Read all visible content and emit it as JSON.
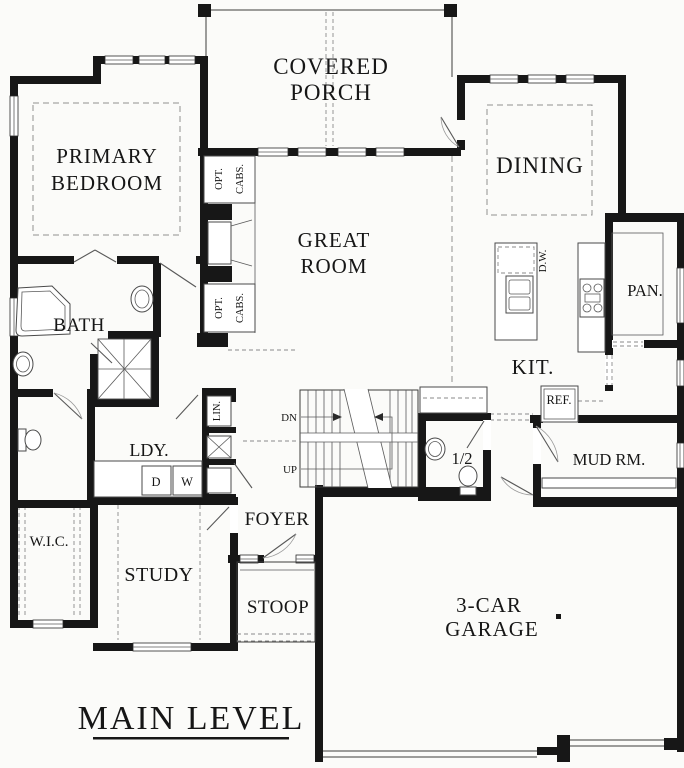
{
  "page": {
    "background": "#fbfbf9",
    "ink": "#171717"
  },
  "title": {
    "main_level": "MAIN LEVEL"
  },
  "labels": {
    "covered_porch": [
      "COVERED",
      "PORCH"
    ],
    "primary_bedroom": [
      "PRIMARY",
      "BEDROOM"
    ],
    "great_room": [
      "GREAT",
      "ROOM"
    ],
    "garage": [
      "3-CAR",
      "GARAGE"
    ],
    "dining": "DINING",
    "bath": "BATH",
    "kitchen": "KIT.",
    "pantry": "PAN.",
    "mud_room": "MUD RM.",
    "laundry": "LDY.",
    "linen": "LIN.",
    "wic": "W.I.C.",
    "study": "STUDY",
    "foyer": "FOYER",
    "stoop": "STOOP",
    "half_bath": "1/2",
    "opt_cabs_upper": [
      "OPT.",
      "CABS."
    ],
    "opt_cabs_lower": [
      "OPT.",
      "CABS."
    ],
    "dishwasher": "D.W.",
    "refrigerator": "REF.",
    "dryer": "D",
    "washer": "W",
    "stair_down": "DN",
    "stair_up": "UP"
  }
}
